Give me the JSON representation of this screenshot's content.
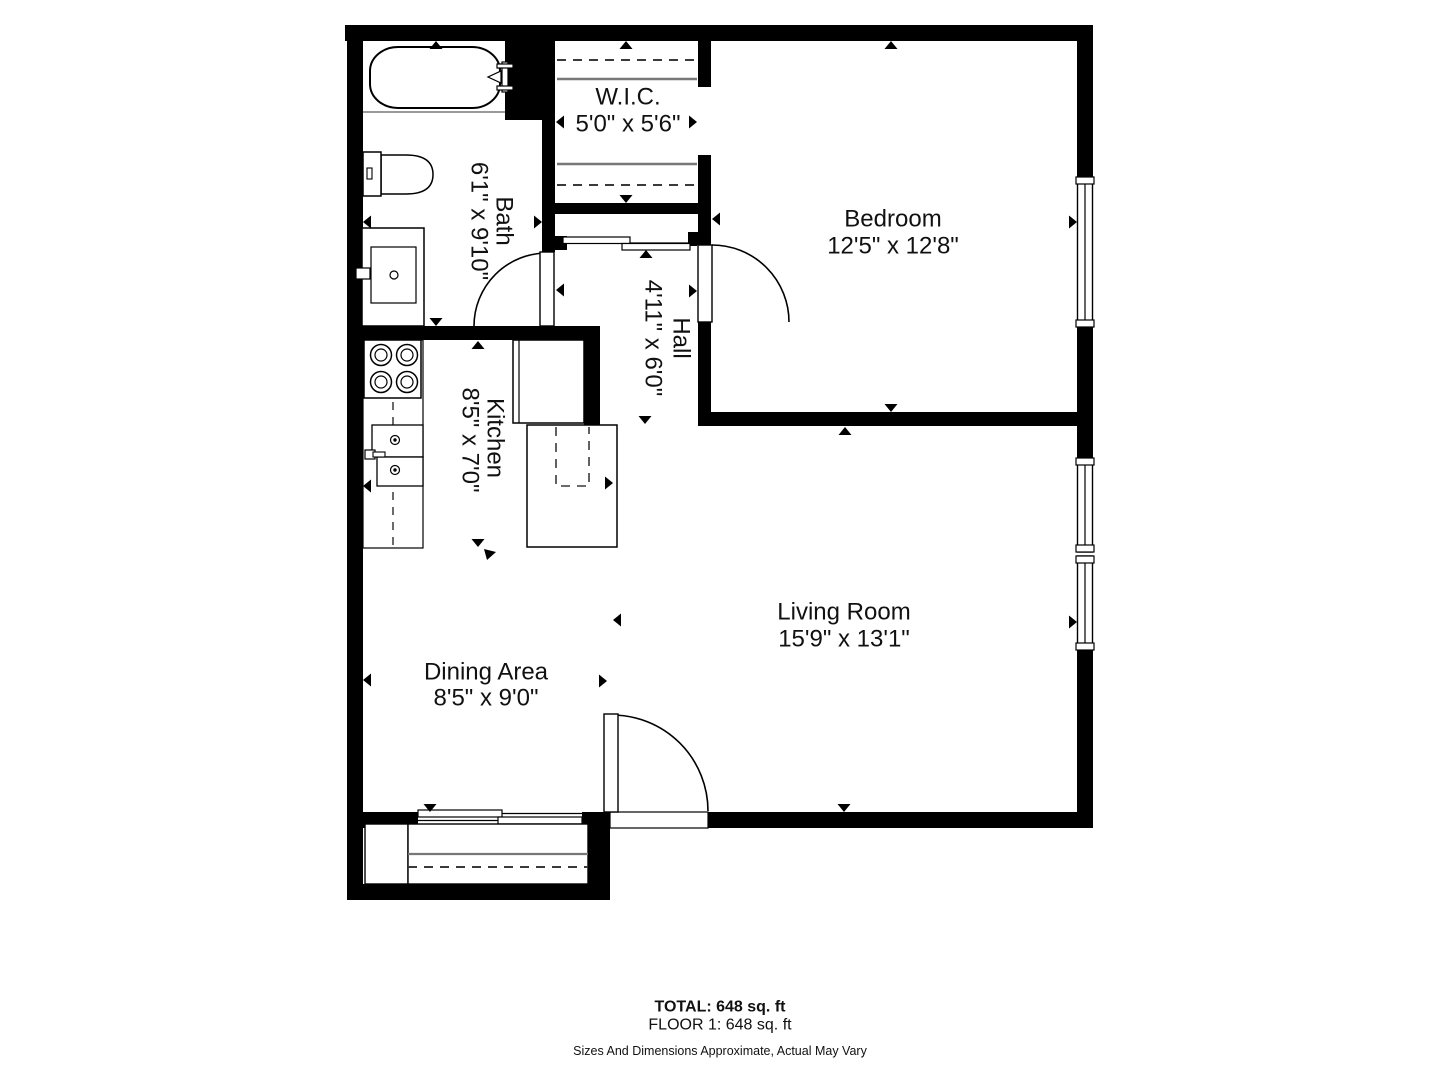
{
  "rooms": {
    "wic": {
      "name": "W.I.C.",
      "dims": "5'0\" x 5'6\""
    },
    "bedroom": {
      "name": "Bedroom",
      "dims": "12'5\" x 12'8\""
    },
    "bath": {
      "name": "Bath",
      "dims": "6'1\" x 9'10\""
    },
    "hall": {
      "name": "Hall",
      "dims": "4'11\" x 6'0\""
    },
    "kitchen": {
      "name": "Kitchen",
      "dims": "8'5\" x 7'0\""
    },
    "living": {
      "name": "Living Room",
      "dims": "15'9\" x 13'1\""
    },
    "dining": {
      "name": "Dining Area",
      "dims": "8'5\" x 9'0\""
    }
  },
  "footer": {
    "total": "TOTAL: 648 sq. ft",
    "floor": "FLOOR 1: 648 sq. ft",
    "disclaimer": "Sizes And Dimensions Approximate, Actual May Vary"
  },
  "colors": {
    "wall": "#000000",
    "text": "#111111",
    "shelf_line": "#777777",
    "dash_line": "#3a3a3a"
  }
}
